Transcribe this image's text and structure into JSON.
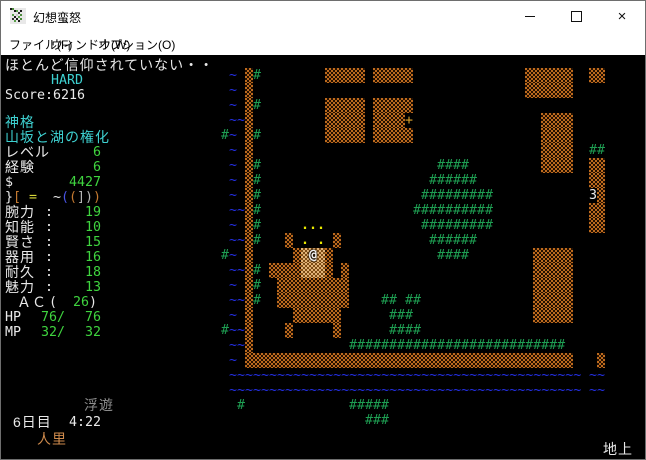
{
  "window": {
    "title": "幻想蛮怒"
  },
  "titlebar_buttons": {
    "minimize": "minimize",
    "maximize": "maximize",
    "close": "×"
  },
  "menu": {
    "items": [
      {
        "id": "file",
        "label": "ファイル(F)",
        "x": 8
      },
      {
        "id": "window",
        "label": "ウィンドウ(W)",
        "x": 50
      },
      {
        "id": "options",
        "label": "オプション(O)",
        "x": 97
      }
    ]
  },
  "palette": {
    "w": "#e9e9e9",
    "cy": "#3ed1d1",
    "g": "#3fd43f",
    "or": "#c47930",
    "ye": "#d8d838",
    "bl": "#4853e4",
    "lg": "#b4b4b4",
    "gr": "#8d8d8d",
    "tn": "#ce8a4c",
    "tr": "#1e9e52",
    "wa": "#2430e8",
    "dt": "#e8e800",
    "dr": "#dca32c",
    "nm": "#e9e9e9",
    "pl": "#f2f2f2",
    "wall_orange": "#bc6a1e",
    "floor_tan": "#e2b377",
    "bg": "#000000",
    "titlebar_bg": "#ffffff"
  },
  "sidebar": {
    "lines": [
      {
        "n": "status-message",
        "y": 3,
        "parts": [
          {
            "x": 4,
            "t": "ほとんど信仰されていない・・",
            "c": "w",
            "jp": 1
          }
        ]
      },
      {
        "n": "difficulty",
        "y": 18,
        "parts": [
          {
            "x": 50,
            "t": "HARD",
            "c": "cy"
          }
        ]
      },
      {
        "n": "score-row",
        "y": 33,
        "parts": [
          {
            "x": 4,
            "t": "Score:6216",
            "c": "w"
          }
        ]
      },
      {
        "n": "deity-label",
        "y": 60,
        "parts": [
          {
            "x": 4,
            "t": "神格",
            "c": "cy",
            "jp": 1
          }
        ]
      },
      {
        "n": "deity-title",
        "y": 75,
        "parts": [
          {
            "x": 4,
            "t": "山坂と湖の権化",
            "c": "cy",
            "jp": 1
          }
        ]
      },
      {
        "n": "level-row",
        "y": 90,
        "parts": [
          {
            "x": 4,
            "t": "レベル",
            "c": "w",
            "jp": 1
          },
          {
            "x": 92,
            "t": "6",
            "c": "g"
          }
        ]
      },
      {
        "n": "exp-row",
        "y": 105,
        "parts": [
          {
            "x": 4,
            "t": "経験",
            "c": "w",
            "jp": 1
          },
          {
            "x": 92,
            "t": "6",
            "c": "g"
          }
        ]
      },
      {
        "n": "gold-row",
        "y": 120,
        "parts": [
          {
            "x": 4,
            "t": "$",
            "c": "w"
          },
          {
            "x": 68,
            "t": "4427",
            "c": "g"
          }
        ]
      },
      {
        "n": "equipment-row",
        "y": 135,
        "parts": [
          {
            "x": 4,
            "t": "}",
            "c": "w"
          },
          {
            "x": 12,
            "t": "[",
            "c": "or"
          },
          {
            "x": 28,
            "t": "=",
            "c": "ye"
          },
          {
            "x": 52,
            "t": "~",
            "c": "w"
          },
          {
            "x": 60,
            "t": "(",
            "c": "bl"
          },
          {
            "x": 68,
            "t": "(",
            "c": "or"
          },
          {
            "x": 76,
            "t": "]",
            "c": "lg"
          },
          {
            "x": 84,
            "t": ")",
            "c": "lg"
          },
          {
            "x": 92,
            "t": ")",
            "c": "or"
          }
        ]
      },
      {
        "n": "stat-str",
        "y": 150,
        "parts": [
          {
            "x": 4,
            "t": "腕力",
            "c": "w",
            "jp": 1
          },
          {
            "x": 44,
            "t": ":",
            "c": "w"
          },
          {
            "x": 84,
            "t": "19",
            "c": "g"
          }
        ]
      },
      {
        "n": "stat-int",
        "y": 165,
        "parts": [
          {
            "x": 4,
            "t": "知能",
            "c": "w",
            "jp": 1
          },
          {
            "x": 44,
            "t": ":",
            "c": "w"
          },
          {
            "x": 84,
            "t": "10",
            "c": "g"
          }
        ]
      },
      {
        "n": "stat-wis",
        "y": 180,
        "parts": [
          {
            "x": 4,
            "t": "賢さ",
            "c": "w",
            "jp": 1
          },
          {
            "x": 44,
            "t": ":",
            "c": "w"
          },
          {
            "x": 84,
            "t": "15",
            "c": "g"
          }
        ]
      },
      {
        "n": "stat-dex",
        "y": 195,
        "parts": [
          {
            "x": 4,
            "t": "器用",
            "c": "w",
            "jp": 1
          },
          {
            "x": 44,
            "t": ":",
            "c": "w"
          },
          {
            "x": 84,
            "t": "16",
            "c": "g"
          }
        ]
      },
      {
        "n": "stat-con",
        "y": 210,
        "parts": [
          {
            "x": 4,
            "t": "耐久",
            "c": "w",
            "jp": 1
          },
          {
            "x": 44,
            "t": ":",
            "c": "w"
          },
          {
            "x": 84,
            "t": "18",
            "c": "g"
          }
        ]
      },
      {
        "n": "stat-chr",
        "y": 225,
        "parts": [
          {
            "x": 4,
            "t": "魅力",
            "c": "w",
            "jp": 1
          },
          {
            "x": 44,
            "t": ":",
            "c": "w"
          },
          {
            "x": 84,
            "t": "13",
            "c": "g"
          }
        ]
      },
      {
        "n": "ac-row",
        "y": 240,
        "parts": [
          {
            "x": 16,
            "t": "ＡＣ",
            "c": "w",
            "jp": 1
          },
          {
            "x": 48,
            "t": "(",
            "c": "w"
          },
          {
            "x": 72,
            "t": "26",
            "c": "g"
          },
          {
            "x": 88,
            "t": ")",
            "c": "w"
          }
        ]
      },
      {
        "n": "hp-row",
        "y": 255,
        "parts": [
          {
            "x": 4,
            "t": "HP",
            "c": "w"
          },
          {
            "x": 40,
            "t": "76/",
            "c": "g"
          },
          {
            "x": 84,
            "t": "76",
            "c": "g"
          }
        ]
      },
      {
        "n": "mp-row",
        "y": 270,
        "parts": [
          {
            "x": 4,
            "t": "MP",
            "c": "w"
          },
          {
            "x": 40,
            "t": "32/",
            "c": "g"
          },
          {
            "x": 84,
            "t": "32",
            "c": "g"
          }
        ]
      },
      {
        "n": "status-effect-levitation",
        "y": 343,
        "parts": [
          {
            "x": 83,
            "t": "浮遊",
            "c": "gr",
            "jp": 1
          }
        ]
      },
      {
        "n": "day-time",
        "y": 360,
        "parts": [
          {
            "x": 12,
            "t": "6日目",
            "c": "w",
            "jp": 1
          },
          {
            "x": 68,
            "t": "4:22",
            "c": "w"
          }
        ]
      },
      {
        "n": "location",
        "y": 377,
        "parts": [
          {
            "x": 36,
            "t": "人里",
            "c": "tn",
            "jp": 1
          }
        ]
      },
      {
        "n": "surface-indicator",
        "y": 387,
        "parts": [
          {
            "x": 602,
            "t": "地上",
            "c": "w",
            "jp": 1
          }
        ]
      }
    ]
  },
  "map": {
    "cell_w": 8,
    "cell_h": 15,
    "origin_x": 4,
    "origin_y": 13,
    "legend": {
      "wl": "wall",
      "fl": "shop-floor",
      "tr": "tree",
      "wa": "water",
      "dt": "lit-floor-dots",
      "dr": "door",
      "nm": "shop-number",
      "pl": "player"
    },
    "rows": [
      {
        "r": 0,
        "segs": [
          [
            28,
            "wa",
            "~"
          ],
          [
            30,
            "wl",
            1
          ],
          [
            31,
            "tr",
            "#"
          ],
          [
            40,
            "wl",
            5
          ],
          [
            46,
            "wl",
            5
          ],
          [
            65,
            "wl",
            6
          ],
          [
            73,
            "wl",
            2
          ]
        ]
      },
      {
        "r": 1,
        "segs": [
          [
            28,
            "wa",
            "~"
          ],
          [
            30,
            "wl",
            1
          ],
          [
            65,
            "wl",
            6
          ]
        ]
      },
      {
        "r": 2,
        "segs": [
          [
            28,
            "wa",
            "~"
          ],
          [
            30,
            "wl",
            1
          ],
          [
            31,
            "tr",
            "#"
          ],
          [
            40,
            "wl",
            5
          ],
          [
            46,
            "wl",
            5
          ]
        ]
      },
      {
        "r": 3,
        "segs": [
          [
            28,
            "wa",
            "~~"
          ],
          [
            30,
            "wl",
            1
          ],
          [
            40,
            "wl",
            5
          ],
          [
            46,
            "wl",
            4
          ],
          [
            50,
            "dr",
            "+"
          ],
          [
            67,
            "wl",
            4
          ]
        ]
      },
      {
        "r": 4,
        "segs": [
          [
            27,
            "tr",
            "#"
          ],
          [
            28,
            "wa",
            "~"
          ],
          [
            30,
            "wl",
            1
          ],
          [
            31,
            "tr",
            "#"
          ],
          [
            40,
            "wl",
            5
          ],
          [
            46,
            "wl",
            5
          ],
          [
            67,
            "wl",
            4
          ]
        ]
      },
      {
        "r": 5,
        "segs": [
          [
            28,
            "wa",
            "~"
          ],
          [
            30,
            "wl",
            1
          ],
          [
            67,
            "wl",
            4
          ],
          [
            73,
            "tr",
            "##"
          ]
        ]
      },
      {
        "r": 6,
        "segs": [
          [
            28,
            "wa",
            "~"
          ],
          [
            30,
            "wl",
            1
          ],
          [
            31,
            "tr",
            "#"
          ],
          [
            54,
            "tr",
            "####"
          ],
          [
            67,
            "wl",
            4
          ],
          [
            73,
            "wl",
            2
          ]
        ]
      },
      {
        "r": 7,
        "segs": [
          [
            28,
            "wa",
            "~"
          ],
          [
            30,
            "wl",
            1
          ],
          [
            31,
            "tr",
            "#"
          ],
          [
            53,
            "tr",
            "######"
          ],
          [
            73,
            "wl",
            2
          ]
        ]
      },
      {
        "r": 8,
        "segs": [
          [
            28,
            "wa",
            "~"
          ],
          [
            30,
            "wl",
            1
          ],
          [
            31,
            "tr",
            "#"
          ],
          [
            52,
            "tr",
            "#########"
          ],
          [
            73,
            "nm",
            "3"
          ],
          [
            74,
            "wl",
            1
          ]
        ]
      },
      {
        "r": 9,
        "segs": [
          [
            28,
            "wa",
            "~~"
          ],
          [
            30,
            "wl",
            1
          ],
          [
            31,
            "tr",
            "#"
          ],
          [
            51,
            "tr",
            "##########"
          ],
          [
            73,
            "wl",
            2
          ]
        ]
      },
      {
        "r": 10,
        "segs": [
          [
            28,
            "wa",
            "~"
          ],
          [
            30,
            "wl",
            1
          ],
          [
            31,
            "tr",
            "#"
          ],
          [
            37,
            "dt",
            "..."
          ],
          [
            52,
            "tr",
            "#########"
          ],
          [
            73,
            "wl",
            2
          ]
        ]
      },
      {
        "r": 11,
        "segs": [
          [
            28,
            "wa",
            "~~"
          ],
          [
            30,
            "wl",
            1
          ],
          [
            31,
            "tr",
            "#"
          ],
          [
            35,
            "wl",
            1
          ],
          [
            37,
            "dt",
            ". ."
          ],
          [
            41,
            "wl",
            1
          ],
          [
            53,
            "tr",
            "######"
          ]
        ]
      },
      {
        "r": 12,
        "segs": [
          [
            27,
            "tr",
            "#"
          ],
          [
            28,
            "wa",
            "~"
          ],
          [
            30,
            "wl",
            1
          ],
          [
            36,
            "wl",
            1
          ],
          [
            37,
            "fl",
            3
          ],
          [
            38,
            "pl",
            "@"
          ],
          [
            40,
            "wl",
            1
          ],
          [
            54,
            "tr",
            "####"
          ],
          [
            66,
            "wl",
            5
          ]
        ]
      },
      {
        "r": 13,
        "segs": [
          [
            28,
            "wa",
            "~~"
          ],
          [
            30,
            "wl",
            1
          ],
          [
            31,
            "tr",
            "#"
          ],
          [
            33,
            "wl",
            4
          ],
          [
            37,
            "fl",
            3
          ],
          [
            40,
            "wl",
            1
          ],
          [
            42,
            "wl",
            1
          ],
          [
            66,
            "wl",
            5
          ]
        ]
      },
      {
        "r": 14,
        "segs": [
          [
            28,
            "wa",
            "~"
          ],
          [
            30,
            "wl",
            1
          ],
          [
            31,
            "tr",
            "#"
          ],
          [
            34,
            "wl",
            9
          ],
          [
            66,
            "wl",
            5
          ]
        ]
      },
      {
        "r": 15,
        "segs": [
          [
            28,
            "wa",
            "~~"
          ],
          [
            30,
            "wl",
            1
          ],
          [
            31,
            "tr",
            "#"
          ],
          [
            34,
            "wl",
            9
          ],
          [
            47,
            "tr",
            "## ##"
          ],
          [
            66,
            "wl",
            5
          ]
        ]
      },
      {
        "r": 16,
        "segs": [
          [
            28,
            "wa",
            "~"
          ],
          [
            30,
            "wl",
            1
          ],
          [
            36,
            "wl",
            6
          ],
          [
            48,
            "tr",
            "###"
          ],
          [
            66,
            "wl",
            5
          ]
        ]
      },
      {
        "r": 17,
        "segs": [
          [
            27,
            "tr",
            "#"
          ],
          [
            28,
            "wa",
            "~~"
          ],
          [
            30,
            "wl",
            1
          ],
          [
            35,
            "wl",
            1
          ],
          [
            41,
            "wl",
            1
          ],
          [
            48,
            "tr",
            "####"
          ]
        ]
      },
      {
        "r": 18,
        "segs": [
          [
            28,
            "wa",
            "~~"
          ],
          [
            30,
            "wl",
            1
          ],
          [
            43,
            "tr",
            "###########################"
          ]
        ]
      },
      {
        "r": 19,
        "segs": [
          [
            28,
            "wa",
            "~"
          ],
          [
            30,
            "wl",
            41
          ],
          [
            74,
            "wl",
            1
          ]
        ]
      },
      {
        "r": 20,
        "segs": [
          [
            28,
            "wa",
            "~~~~~~~~~~~~~~~~~~~~~~~~~~~~~~~~~~~~~~~~~~~~"
          ],
          [
            73,
            "wa",
            "~~"
          ]
        ]
      },
      {
        "r": 21,
        "segs": [
          [
            28,
            "wa",
            "~~~~~~~~~~~~~~~~~~~~~~~~~~~~~~~~~~~~~~~~~~~~"
          ],
          [
            73,
            "wa",
            "~~"
          ]
        ]
      },
      {
        "r": 22,
        "segs": [
          [
            29,
            "tr",
            "#"
          ],
          [
            43,
            "tr",
            "#####"
          ]
        ]
      },
      {
        "r": 23,
        "segs": [
          [
            45,
            "tr",
            "###"
          ]
        ]
      }
    ]
  }
}
